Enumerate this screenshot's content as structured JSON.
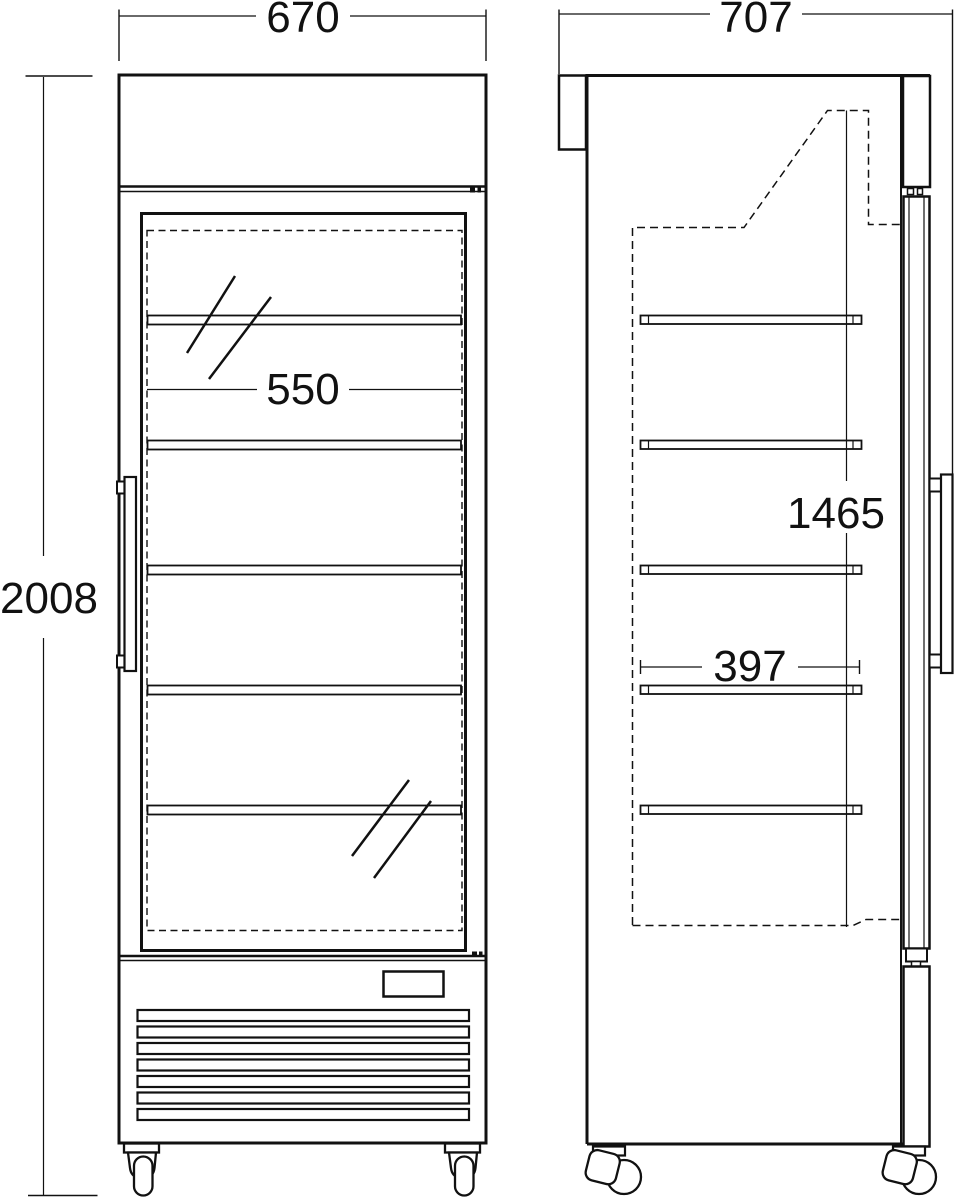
{
  "dimensions": {
    "overall_width": "670",
    "overall_depth": "707",
    "overall_height": "2008",
    "interior_width": "550",
    "interior_height": "1465",
    "shelf_depth": "397"
  },
  "colors": {
    "line": "#111111",
    "background": "#ffffff"
  }
}
